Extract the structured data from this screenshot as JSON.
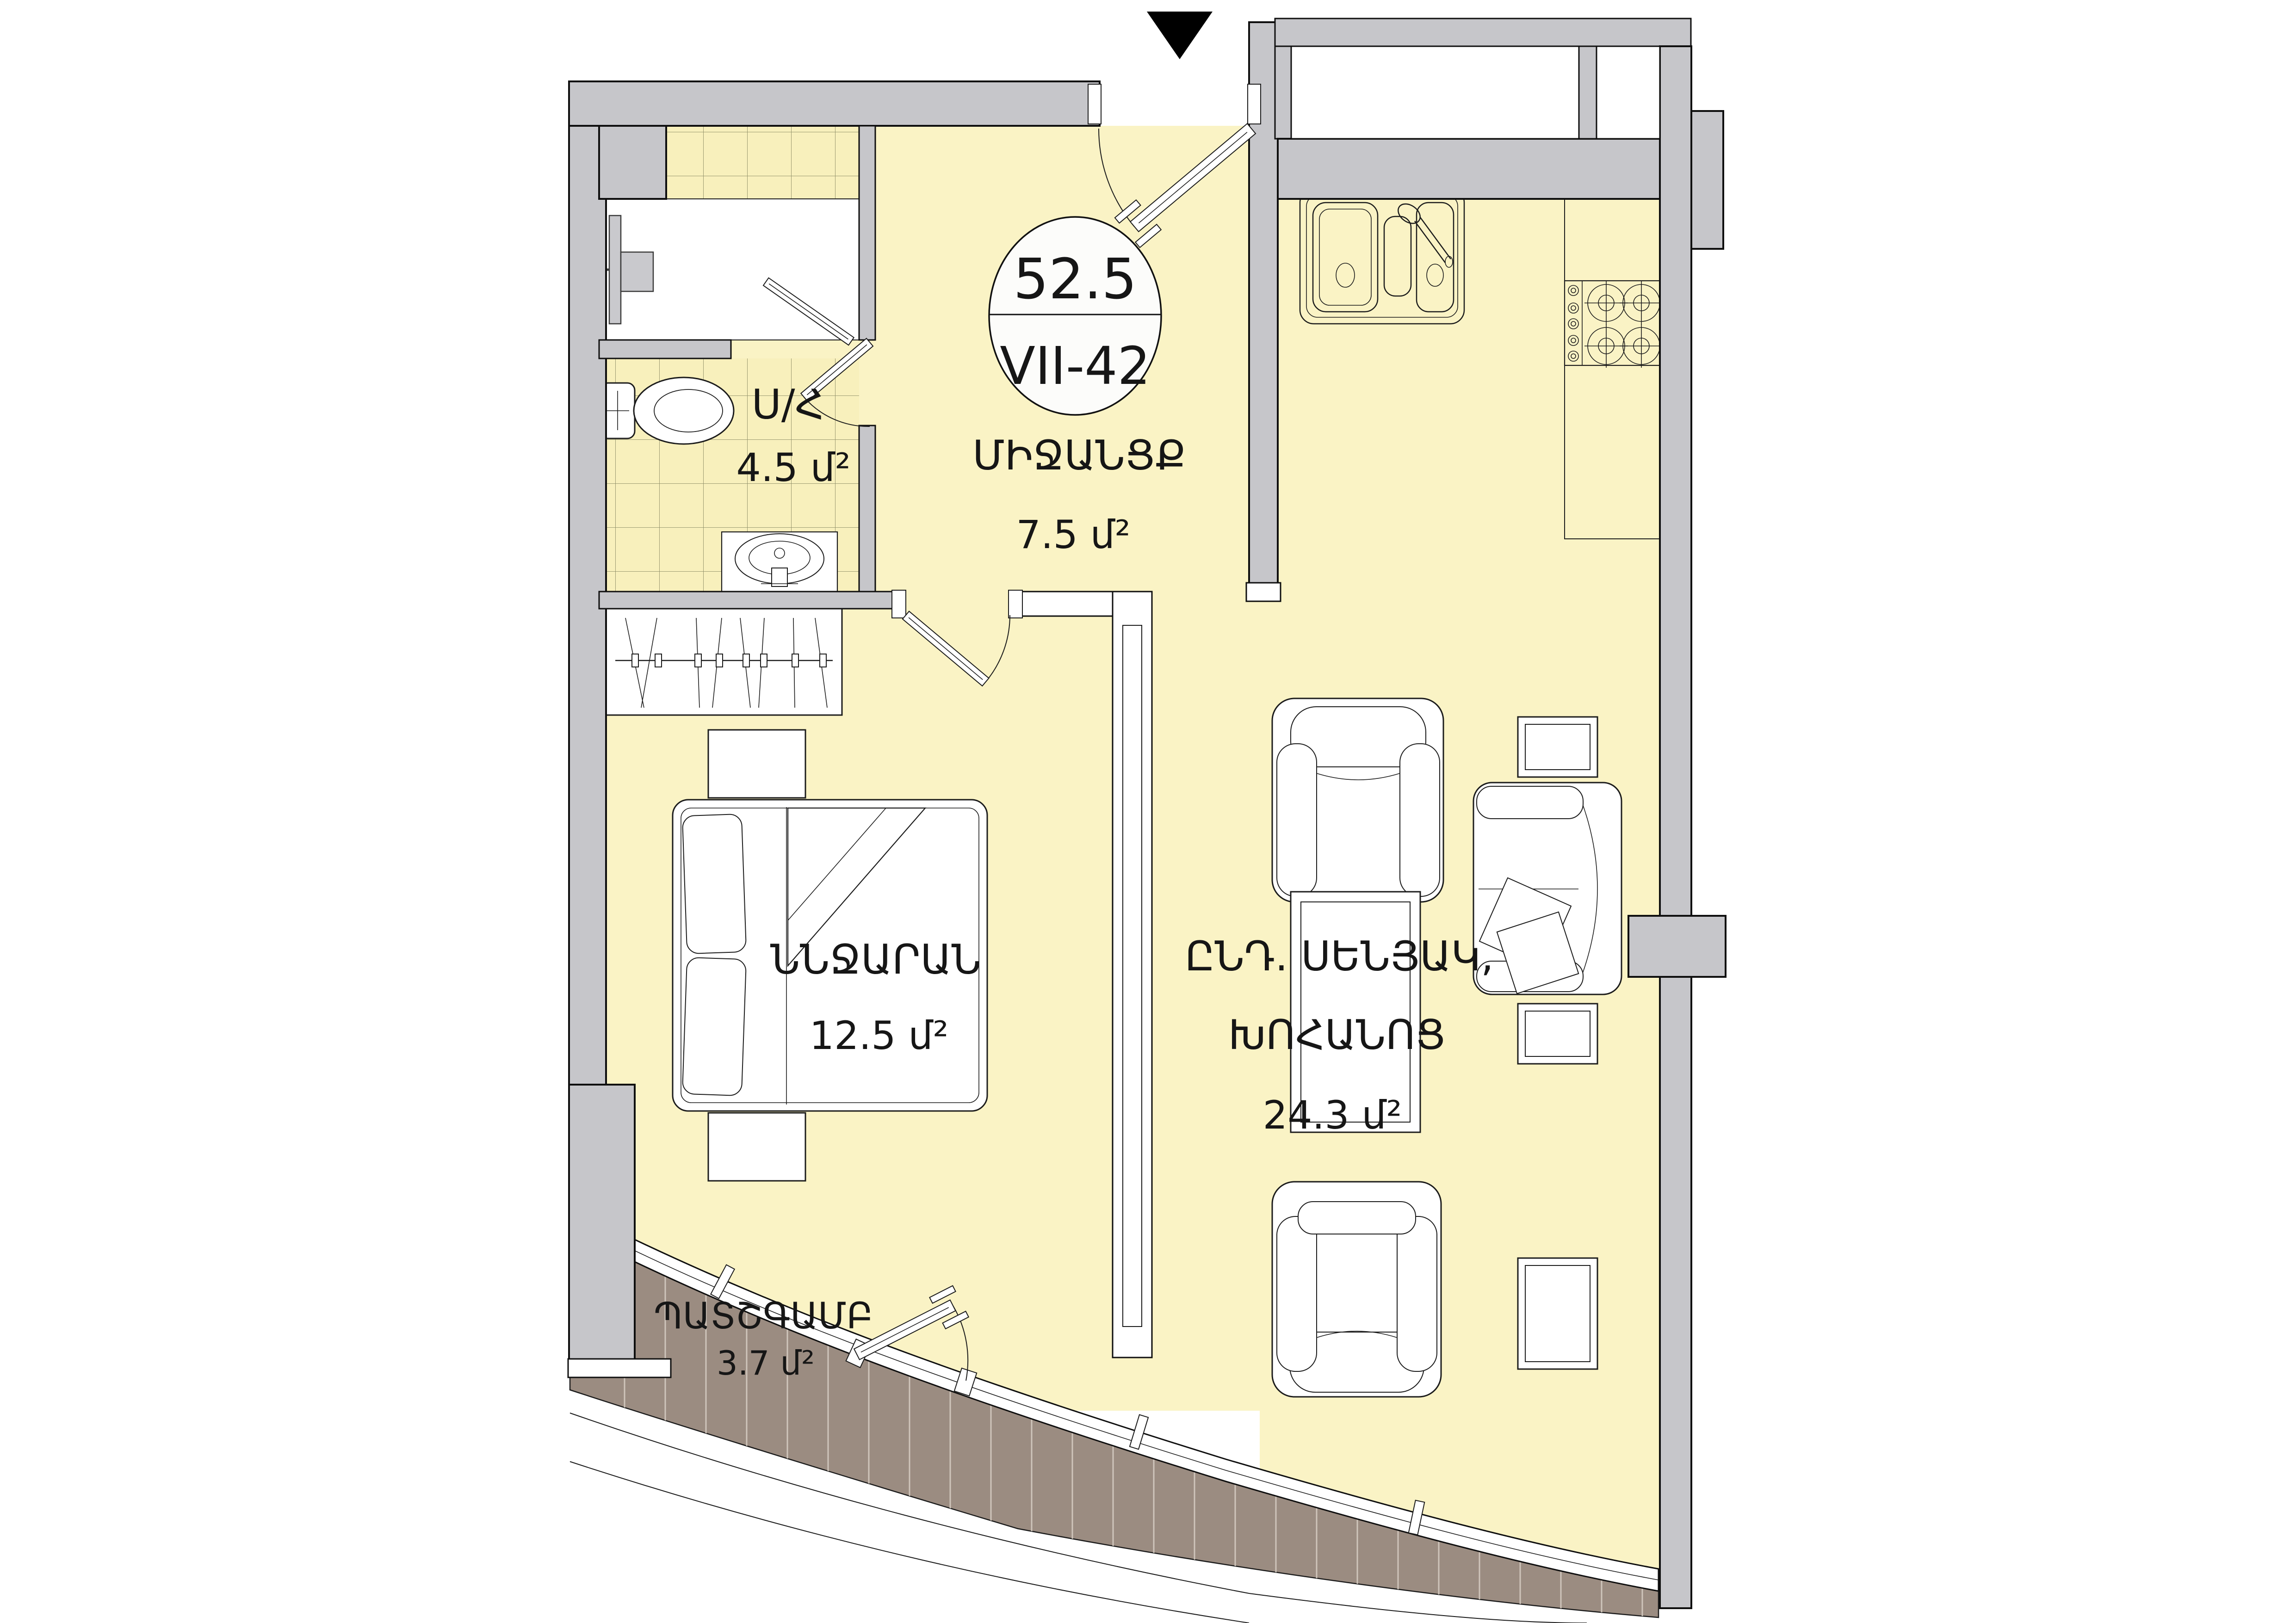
{
  "plan": {
    "marker": "entrance-triangle",
    "badge": {
      "total_area": "52.5",
      "unit_code": "VII-42"
    },
    "rooms": [
      {
        "id": "bathroom",
        "name": "Ս/Հ",
        "area": "4.5 մ²"
      },
      {
        "id": "hallway",
        "name": "ՄԻՋԱՆՑՔ",
        "area": "7.5 մ²"
      },
      {
        "id": "bedroom",
        "name": "ՆՆՋԱՐԱՆ",
        "area": "12.5 մ²"
      },
      {
        "id": "living-kitchen",
        "name_line1": "ԸՆԴ. ՍԵՆՅԱԿ,",
        "name_line2": "ԽՈՀԱՆՈՑ",
        "area": "24.3 մ²"
      },
      {
        "id": "balcony",
        "name": "ՊԱՏՇԳԱՄԲ",
        "area": "3.7 մ²"
      }
    ],
    "colors": {
      "floor": "#FAF3C5",
      "walls": "#C6C6CA",
      "balcony_deck": "#9B8C81",
      "marker": "#000000",
      "outline": "#0f0f0f"
    }
  }
}
